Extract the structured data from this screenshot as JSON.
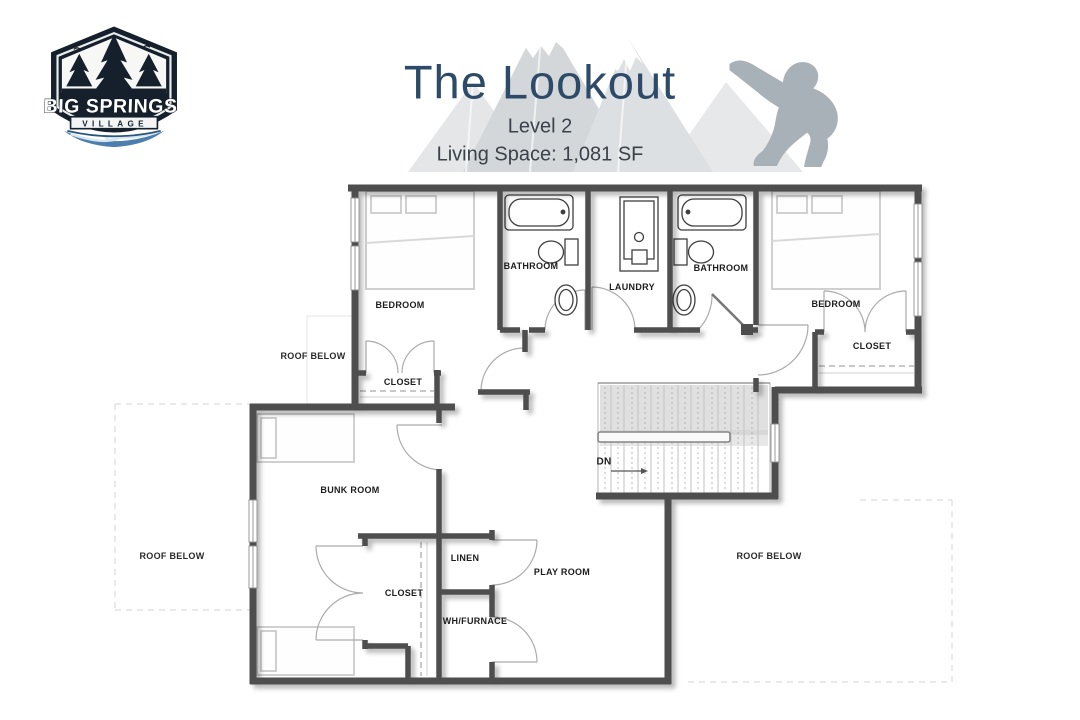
{
  "header": {
    "logo": {
      "primary": "BIG SPRINGS",
      "secondary": "VILLAGE"
    },
    "title": "The Lookout",
    "level": "Level 2",
    "living_space": "Living Space: 1,081 SF"
  },
  "colors": {
    "title_navy": "#2d4b68",
    "subtitle_gray": "#3a424b",
    "wall_gray": "#4e4e4e",
    "label_black": "#1d1d1d",
    "mountain_gray": "#d3d6d9",
    "sasquatch_gray": "#a8b0b8",
    "logo_navy": "#15202c",
    "river_blue": "#4d7fae"
  },
  "floorplan": {
    "bedroom_left": "BEDROOM",
    "bathroom_left": "BATHROOM",
    "laundry": "LAUNDRY",
    "bathroom_right": "BATHROOM",
    "bedroom_right": "BEDROOM",
    "closet_bedroom_right": "CLOSET",
    "closet_hall": "CLOSET",
    "roof_below_upper_left": "ROOF BELOW",
    "bunk_room": "BUNK ROOM",
    "roof_below_left": "ROOF BELOW",
    "closet_bunk": "CLOSET",
    "linen": "LINEN",
    "play_room": "PLAY ROOM",
    "wh_furnace": "WH/FURNACE",
    "roof_below_right": "ROOF BELOW",
    "stairs_down": "DN"
  }
}
